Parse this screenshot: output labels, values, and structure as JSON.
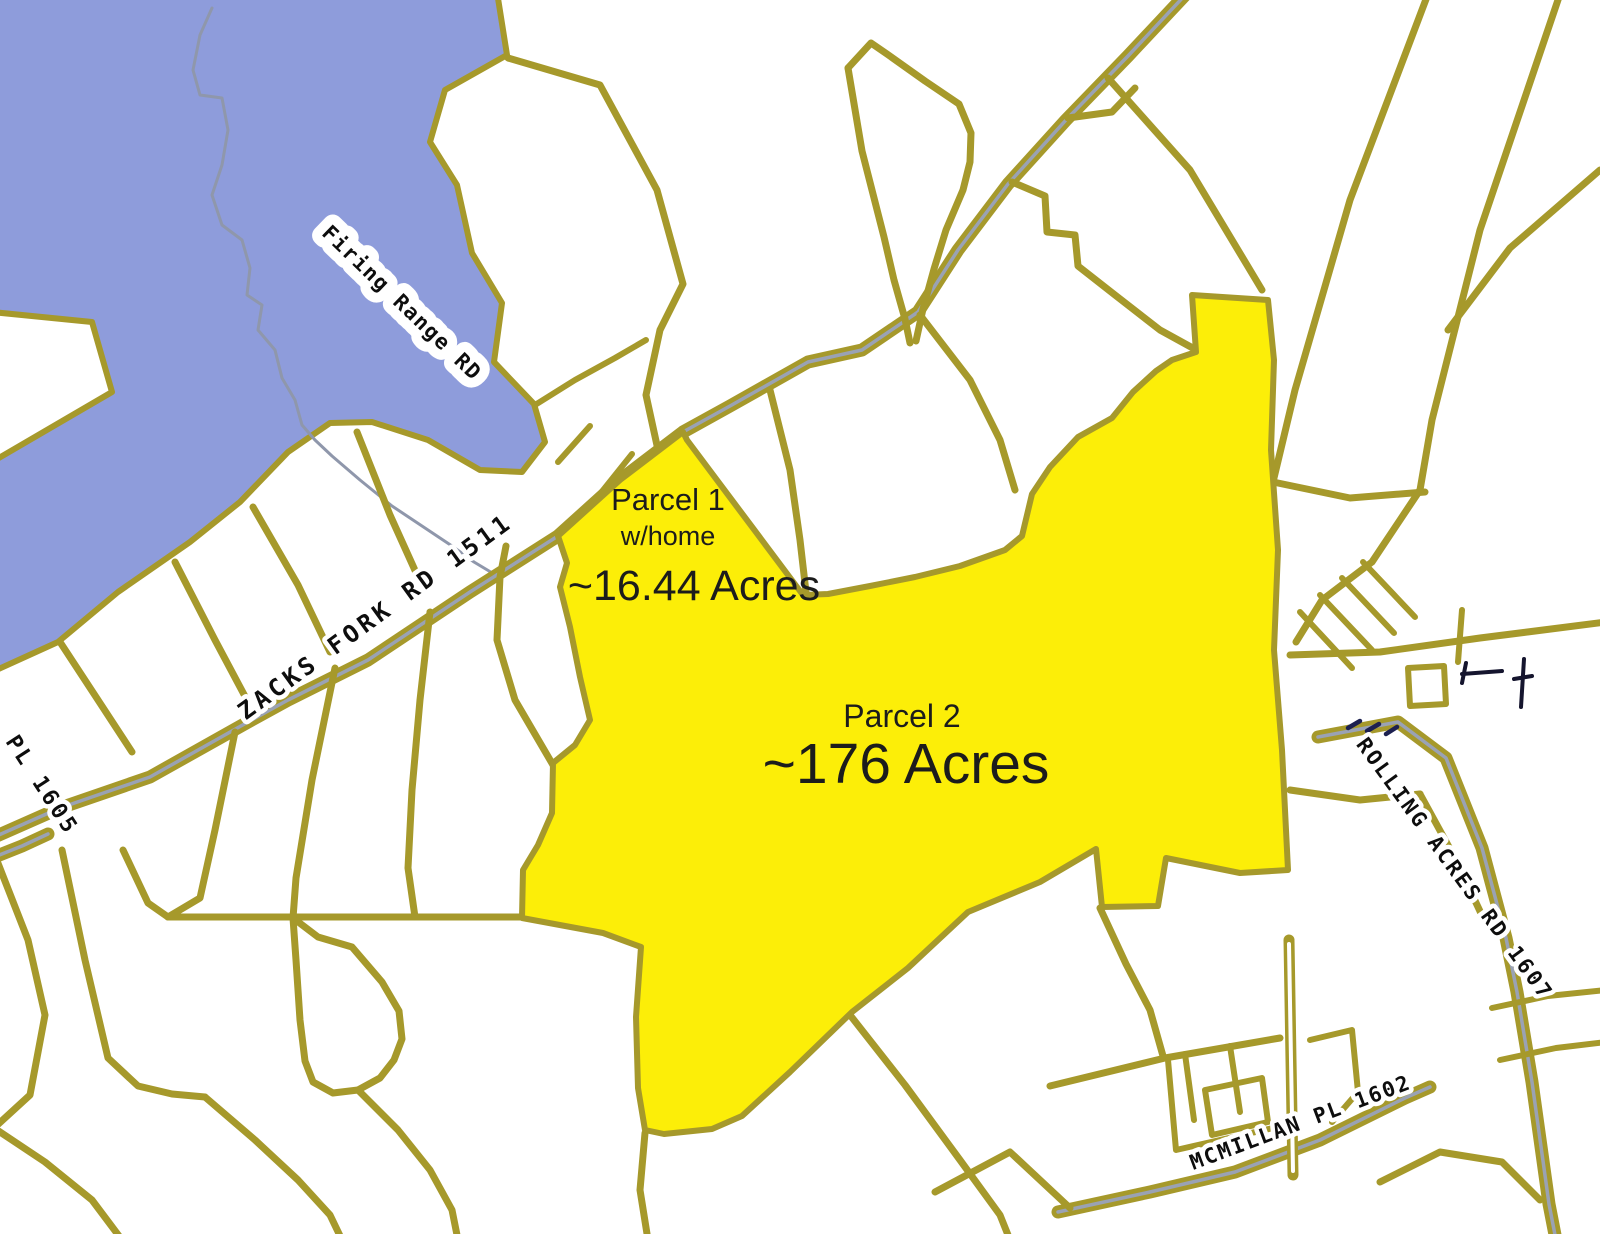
{
  "map": {
    "colors": {
      "background": "#ffffff",
      "water": "#8e9cdb",
      "parcel_line": "#a6992b",
      "road_stripe": "#9aa2b4",
      "highlight": "#fcee08",
      "road_label_text": "#0d0d0d",
      "annotation_text": "#1c1c1c",
      "creek": "#8f97ab",
      "survey_marker": "#15152e"
    },
    "road_labels": {
      "firing_range": "Firing Range RD",
      "zacks_fork": "ZACKS FORK RD 1511",
      "pl_1605": "PL 1605",
      "rolling_acres": "ROLLING ACRES RD 1607",
      "mcmillan": "MCMILLAN PL 1602"
    },
    "parcels": {
      "parcel1": {
        "title": "Parcel 1",
        "subtitle": "w/home",
        "acreage": "~16.44 Acres"
      },
      "parcel2": {
        "title": "Parcel 2",
        "acreage": "~176 Acres"
      }
    }
  }
}
